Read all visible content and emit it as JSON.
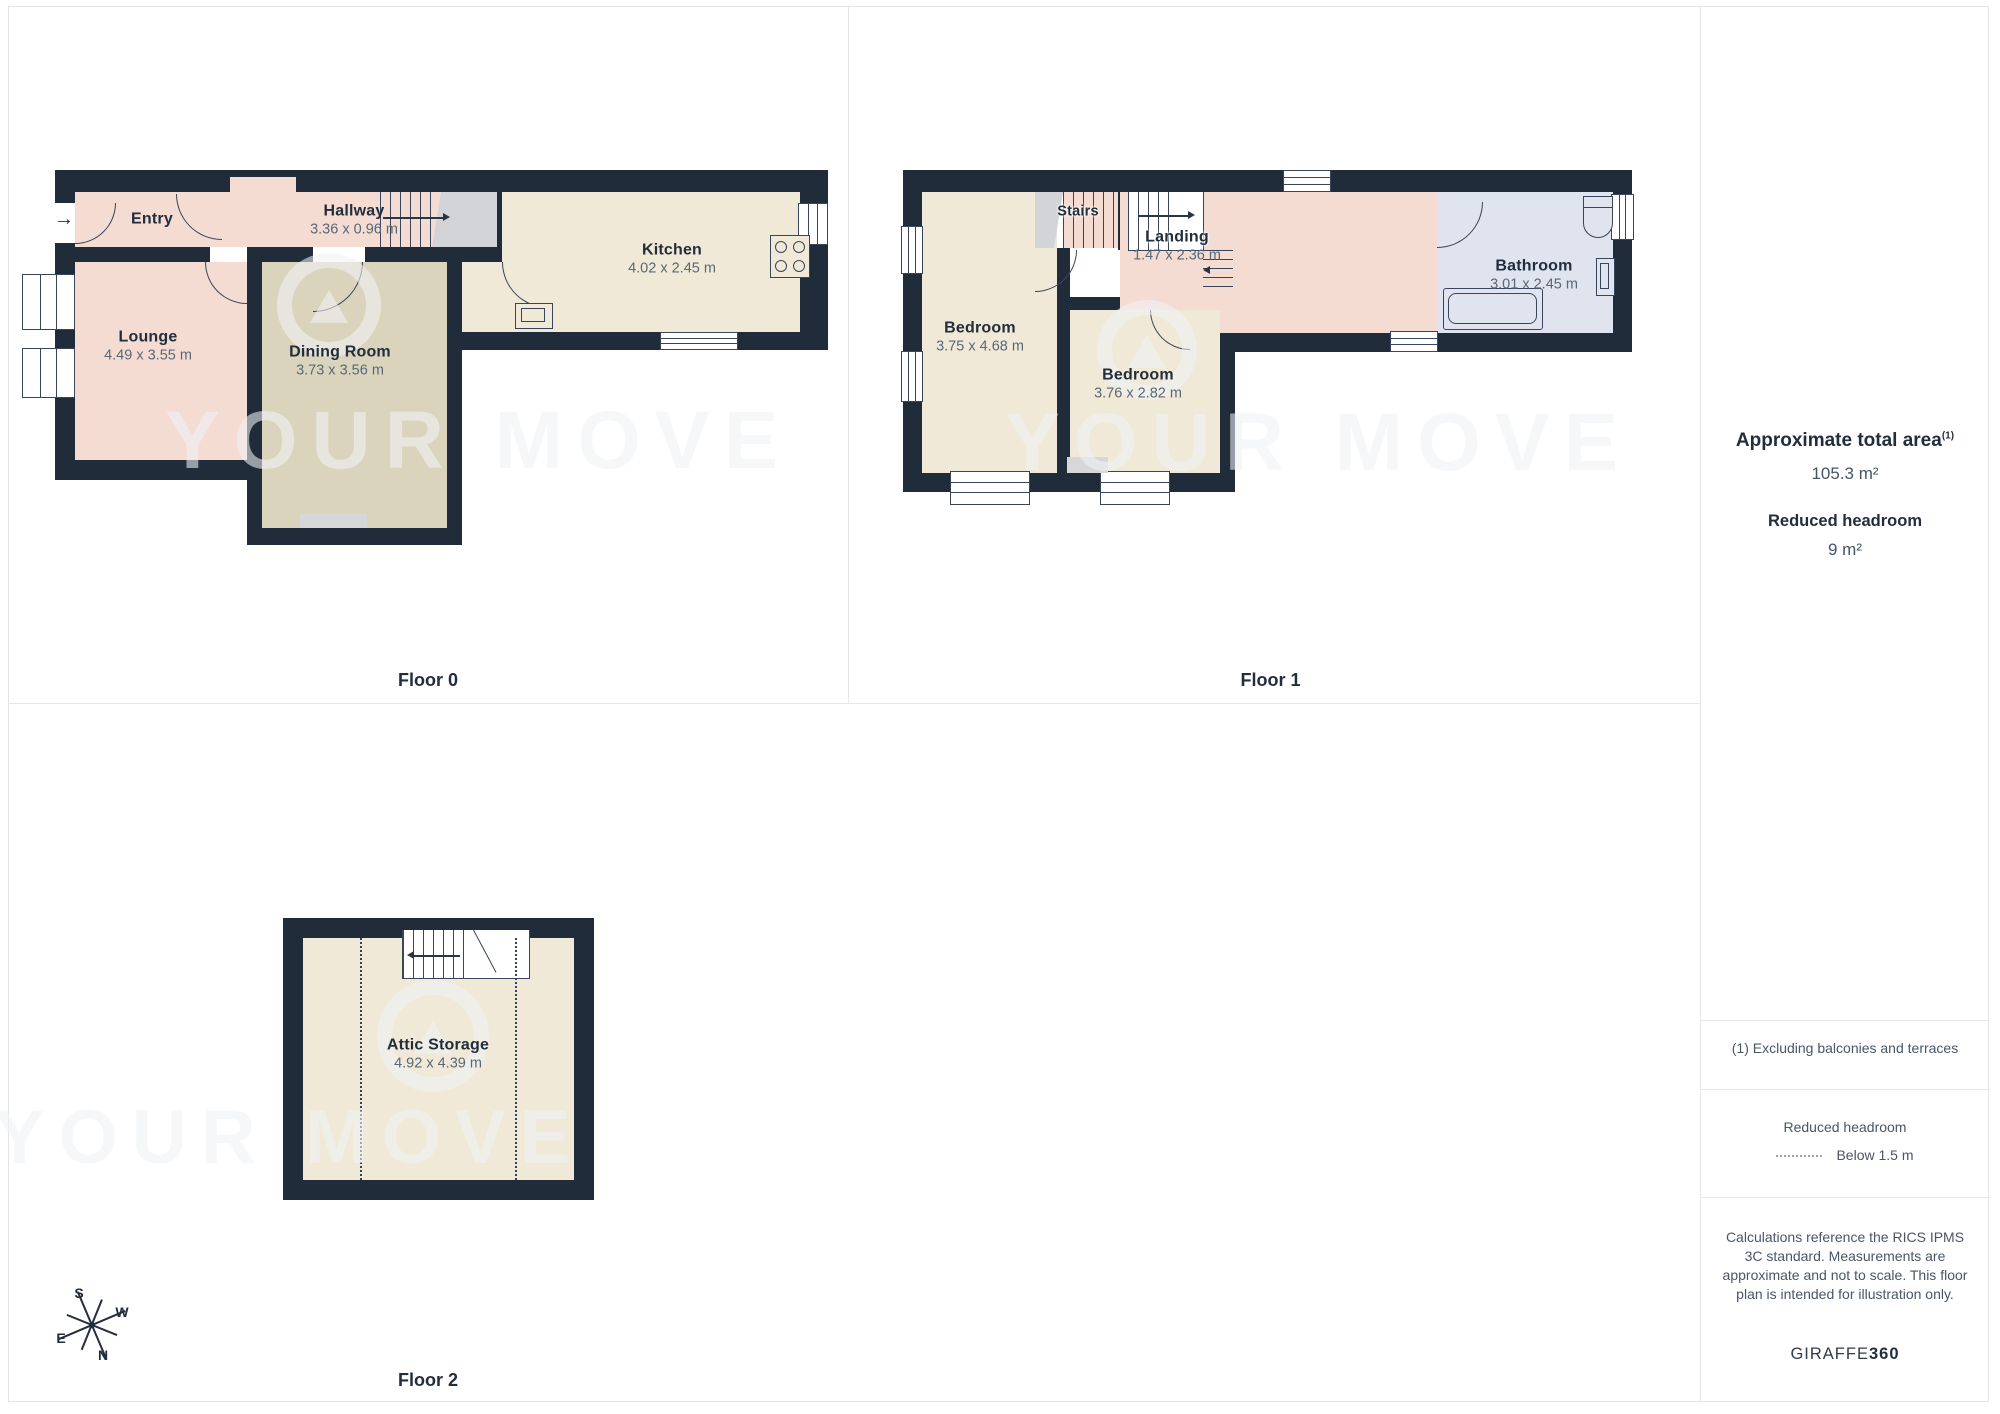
{
  "floors": [
    {
      "label": "Floor 0",
      "rooms": [
        {
          "name": "Entry",
          "dims": ""
        },
        {
          "name": "Hallway",
          "dims": "3.36 x 0.96 m"
        },
        {
          "name": "Lounge",
          "dims": "4.49 x 3.55 m"
        },
        {
          "name": "Dining Room",
          "dims": "3.73 x 3.56 m"
        },
        {
          "name": "Kitchen",
          "dims": "4.02 x 2.45 m"
        }
      ]
    },
    {
      "label": "Floor 1",
      "rooms": [
        {
          "name": "Stairs",
          "dims": ""
        },
        {
          "name": "Landing",
          "dims": "1.47 x 2.36 m"
        },
        {
          "name": "Bedroom",
          "dims": "3.75 x 4.68 m"
        },
        {
          "name": "Bedroom",
          "dims": "3.76 x 2.82 m"
        },
        {
          "name": "Bathroom",
          "dims": "3.01 x 2.45 m"
        }
      ]
    },
    {
      "label": "Floor 2",
      "rooms": [
        {
          "name": "Attic Storage",
          "dims": "4.92 x 4.39 m"
        }
      ]
    }
  ],
  "sidebar": {
    "total_area_label": "Approximate total area",
    "total_area_footnote_marker": "(1)",
    "total_area_value": "105.3 m²",
    "reduced_headroom_label": "Reduced headroom",
    "reduced_headroom_value": "9 m²",
    "footnote": "(1) Excluding balconies and terraces",
    "legend_title": "Reduced headroom",
    "legend_item": "Below 1.5 m",
    "disclaimer": "Calculations reference the RICS IPMS 3C standard. Measurements are approximate and not to scale. This floor plan is intended for illustration only.",
    "brand_name": "GIRAFFE",
    "brand_suffix": "360"
  },
  "compass": {
    "north": "N",
    "south": "S",
    "east": "E",
    "west": "W"
  },
  "watermark": {
    "text": "YOUR MOVE"
  },
  "icons": {
    "entry_arrow": "→"
  },
  "colors": {
    "wall": "#212c3b",
    "room_pink": "#f4dcd3",
    "room_tan": "#dbd4bc",
    "room_cream": "#f1e9d7",
    "room_bathroom": "#dfe4ee",
    "stairs_gray": "#d2d4d7",
    "text_dark": "#232e3d",
    "text_dim": "#5a6777",
    "divider": "#e4e6e9"
  }
}
